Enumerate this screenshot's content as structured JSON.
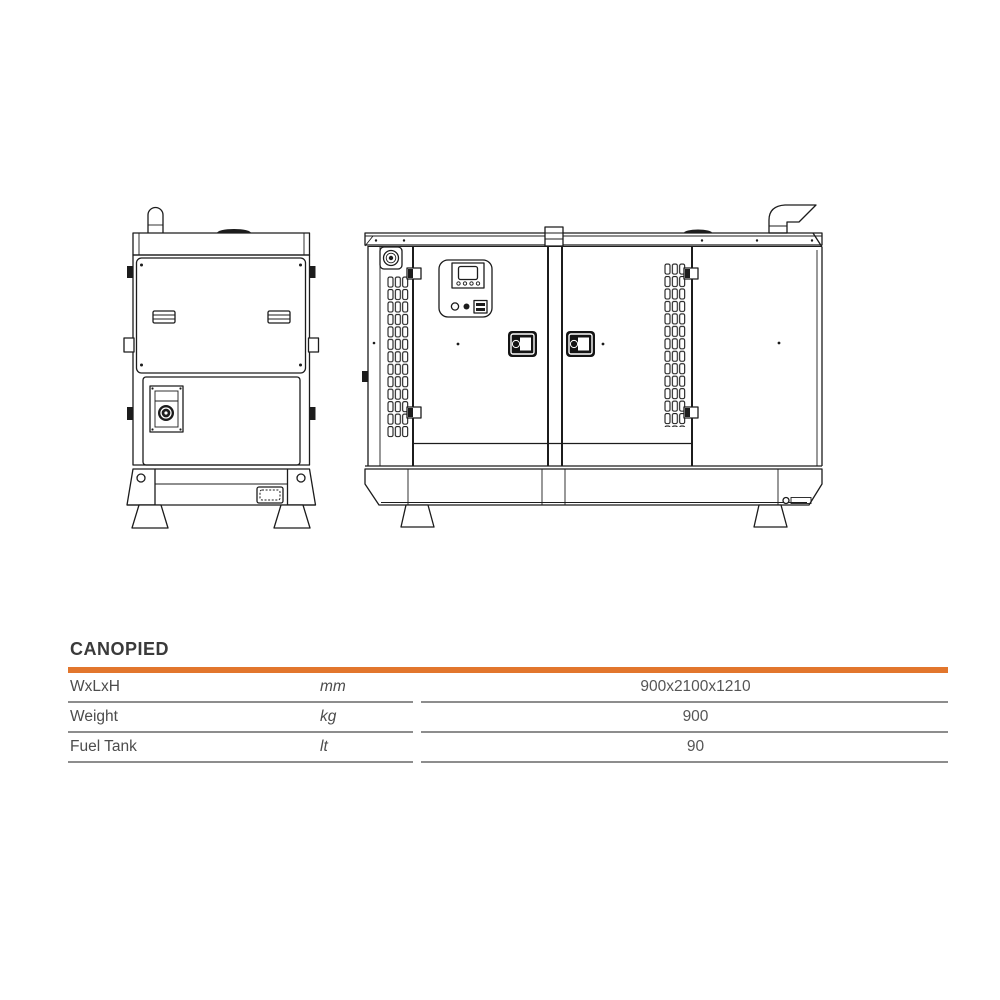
{
  "page": {
    "background": "#FFFFFF"
  },
  "drawings": {
    "front_view_label": "canopied generator front view drawing",
    "side_view_label": "canopied generator side view drawing",
    "line_color": "#1C1C1C"
  },
  "table": {
    "title": "CANOPIED",
    "accent_color": "#E2762D",
    "divider_color": "#8D8D8D",
    "columns": [
      "parameter",
      "unit",
      "value"
    ],
    "rows": [
      {
        "label": "WxLxH",
        "unit": "mm",
        "value": "900x2100x1210"
      },
      {
        "label": "Weight",
        "unit": "kg",
        "value": "900"
      },
      {
        "label": "Fuel Tank",
        "unit": "lt",
        "value": "90"
      }
    ]
  }
}
